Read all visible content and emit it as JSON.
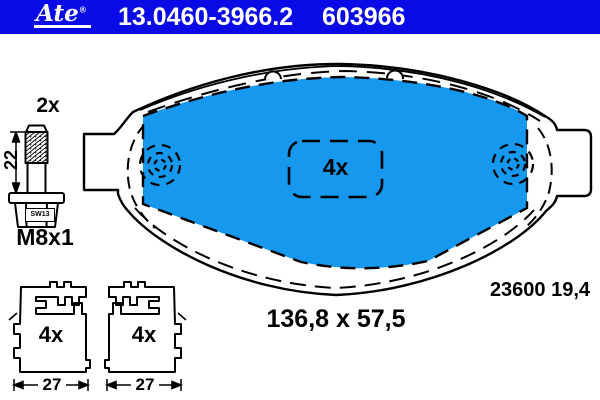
{
  "header": {
    "brand": "Ate",
    "brand_registered": "®",
    "part_number": "13.0460-3966.2",
    "part_code": "603966",
    "background_color": "#0a0ae6",
    "text_color": "#ffffff"
  },
  "bolt": {
    "quantity": "2x",
    "length_mm": "22",
    "wrench_size": "SW13",
    "thread": "M8x1"
  },
  "pad": {
    "quantity": "4x",
    "size_label": "136,8 x 57,5",
    "reference": "23600 19,4",
    "fill_color": "#1598ee"
  },
  "clips": {
    "left": {
      "quantity": "4x",
      "width_mm": "27"
    },
    "right": {
      "quantity": "4x",
      "width_mm": "27"
    }
  },
  "colors": {
    "line": "#000000",
    "banner_blue": "#0a0ae6",
    "pad_blue": "#1598ee"
  }
}
